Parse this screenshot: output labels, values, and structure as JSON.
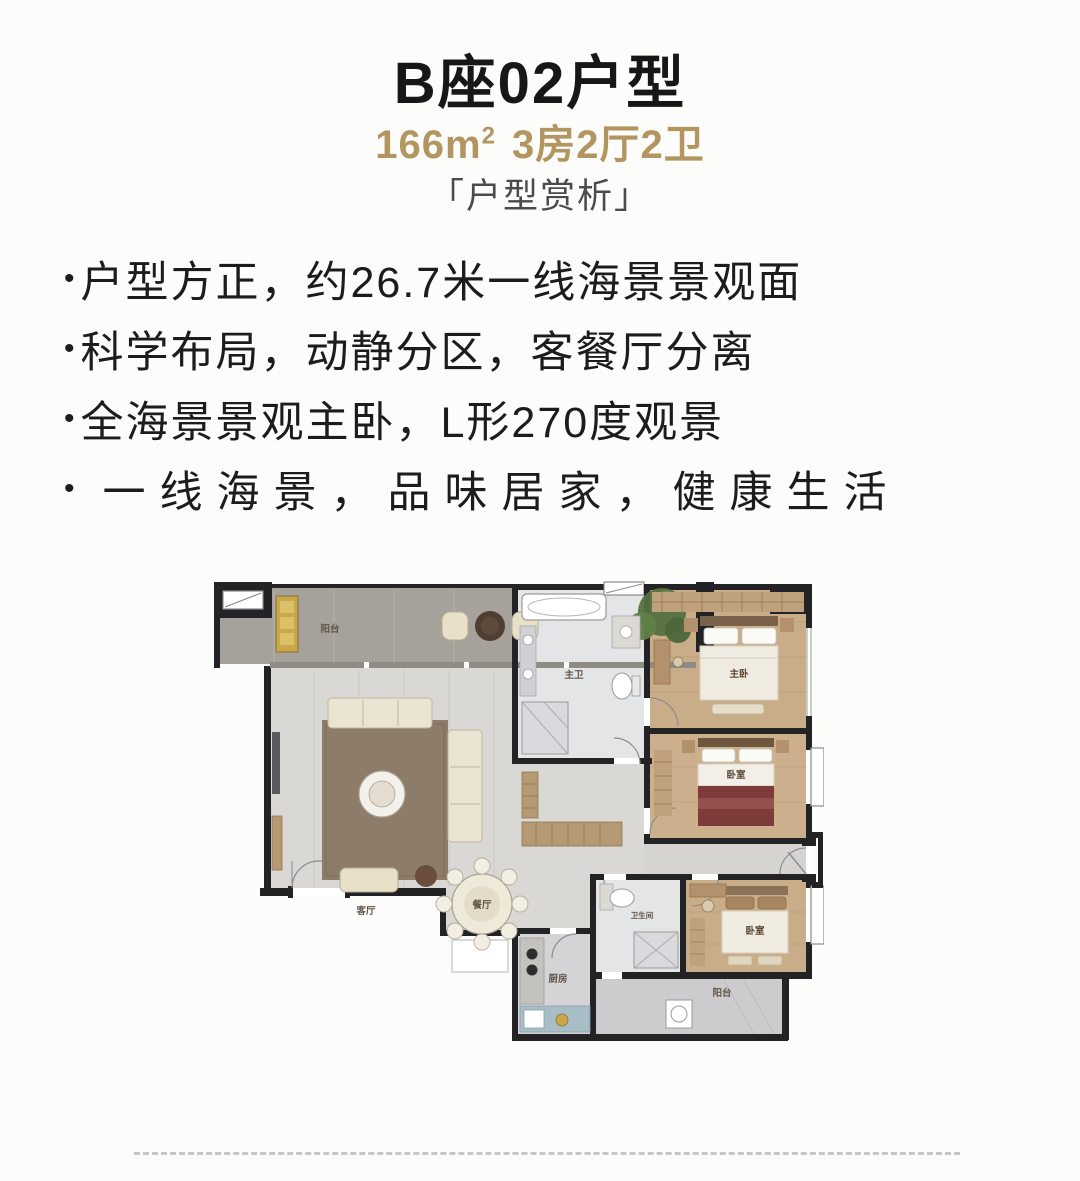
{
  "header": {
    "title": "B座02户型",
    "area": "166m",
    "area_sup": "2",
    "spec": "3房2厅2卫",
    "section_label": "「户型赏析」"
  },
  "bullet_marker": "•",
  "bullets": [
    "户型方正，约26.7米一线海景景观面",
    "科学布局，动静分区，客餐厅分离",
    "全海景景观主卧，L形270度观景",
    "一线海景，品味居家，健康生活"
  ],
  "floorplan": {
    "rooms": {
      "balcony": "阳台",
      "living": "客厅",
      "dining": "餐厅",
      "master_bath": "主卫",
      "master_bedroom": "主卧",
      "bedroom2": "卧室",
      "bedroom3": "卧室",
      "kitchen": "厨房",
      "bath2": "卫生间",
      "utility_balcony": "阳台"
    }
  },
  "colors": {
    "accent_gold": "#b2955f",
    "wall": "#232326"
  }
}
